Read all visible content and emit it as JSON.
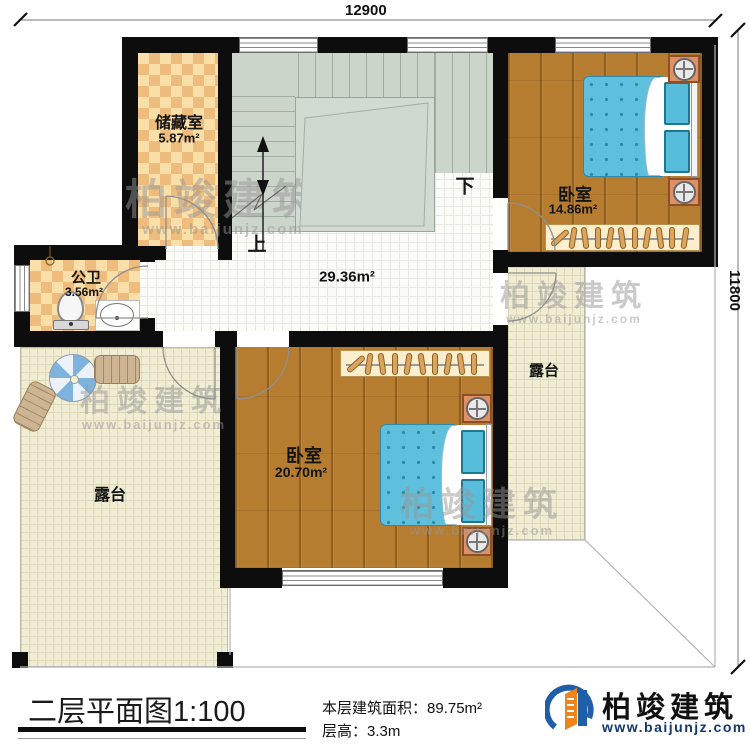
{
  "dimensions": {
    "top": "12900",
    "right": "11800"
  },
  "rooms": {
    "storage": {
      "name": "储藏室",
      "area": "5.87m²"
    },
    "bathroom": {
      "name": "公卫",
      "area": "3.56m²"
    },
    "bedroom1": {
      "name": "卧室",
      "area": "14.86m²"
    },
    "bedroom2": {
      "name": "卧室",
      "area": "20.70m²"
    },
    "hallway": {
      "area": "29.36m²"
    },
    "terrace_left": {
      "name": "露台"
    },
    "terrace_right": {
      "name": "露台"
    }
  },
  "stairs": {
    "up": "上",
    "down": "下"
  },
  "titleblock": {
    "title": "二层平面图",
    "scale": "1:100",
    "floor_area_label": "本层建筑面积：",
    "floor_area_value": "89.75m²",
    "floor_height_label": "层高：",
    "floor_height_value": "3.3m"
  },
  "brand": {
    "name": "柏竣建筑",
    "url": "www.baijunjz.com"
  },
  "colors": {
    "wall": "#0d0d0d",
    "wood_floor": "#b67c30",
    "mattress_blue": "#5fc0dd",
    "checker_light": "#fbdfa9",
    "checker_dark": "#eebc7c",
    "stair_sage": "#ccd5ca",
    "terrace_cream": "#f1edd4",
    "logo_blue": "#1f5fa8",
    "logo_orange": "#f08418"
  }
}
